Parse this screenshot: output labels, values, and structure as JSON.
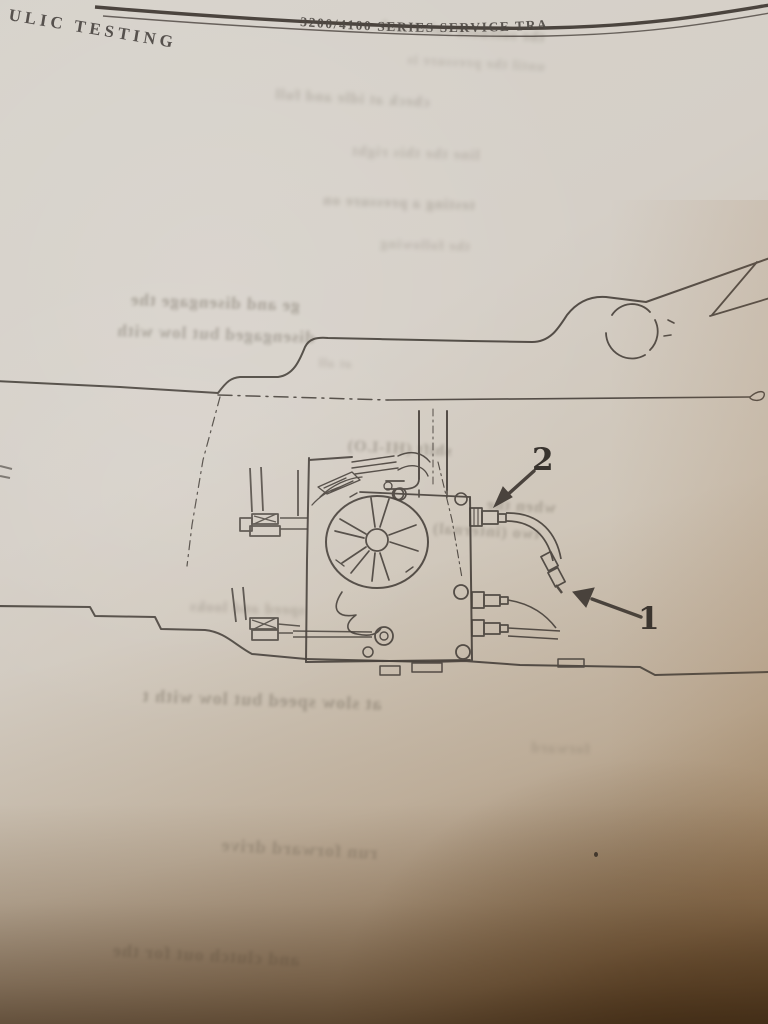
{
  "page": {
    "header_left": "ULIC TESTING",
    "header_right": "3200/4100 SERIES SERVICE TRA"
  },
  "figure": {
    "callouts": {
      "c1": "1",
      "c2": "2"
    }
  },
  "bleed_fragments": [
    "the solenoid valve and",
    "until the pressure is",
    "check at idle and full",
    "line the this right",
    "testing a pressure on",
    "the following",
    "ge and disengage the",
    "disengaged but low with",
    "at all",
    "shift (HI-LO)",
    "when the",
    "two (internal)",
    "speed and looks",
    "at slow speed but low with t",
    "forward",
    "run forward drive",
    "and clutch out for the"
  ]
}
